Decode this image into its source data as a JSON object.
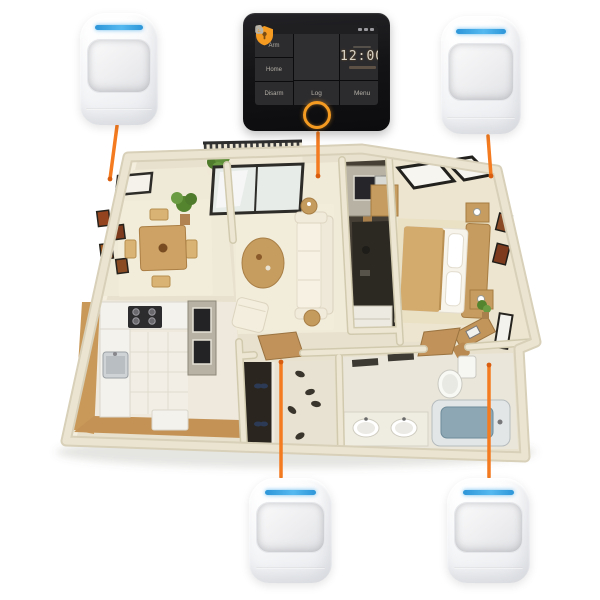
{
  "background_color": "#ffffff",
  "accent_color": "#f47b20",
  "panel": {
    "device": "wifi-alarm-control-panel",
    "time": "12:00",
    "arm_label": "Arm",
    "home_label": "Home",
    "disarm_label": "Disarm",
    "log_label": "Log",
    "menu_label": "Menu",
    "body_color": "#151517",
    "screen_color": "#2f2f32",
    "accent_color": "#f59b22"
  },
  "sensors": {
    "type": "pir-motion-sensor",
    "count": 4,
    "positions": [
      "top-left",
      "top-right",
      "bottom-center",
      "bottom-right"
    ],
    "body_color": "#ffffff",
    "led_color": "#36a3e3"
  },
  "connectors": {
    "count": 5,
    "color": "#f47b20"
  },
  "floorplan": {
    "style": "isometric-3d-apartment",
    "wall_color": "#e8e1cd",
    "floor_color": "#f0ead8",
    "wood_color": "#c9995a",
    "rooms": [
      "dining-room",
      "living-room",
      "balcony",
      "hallway-closet",
      "bedroom",
      "kitchen",
      "entry-hall",
      "bathroom"
    ]
  }
}
